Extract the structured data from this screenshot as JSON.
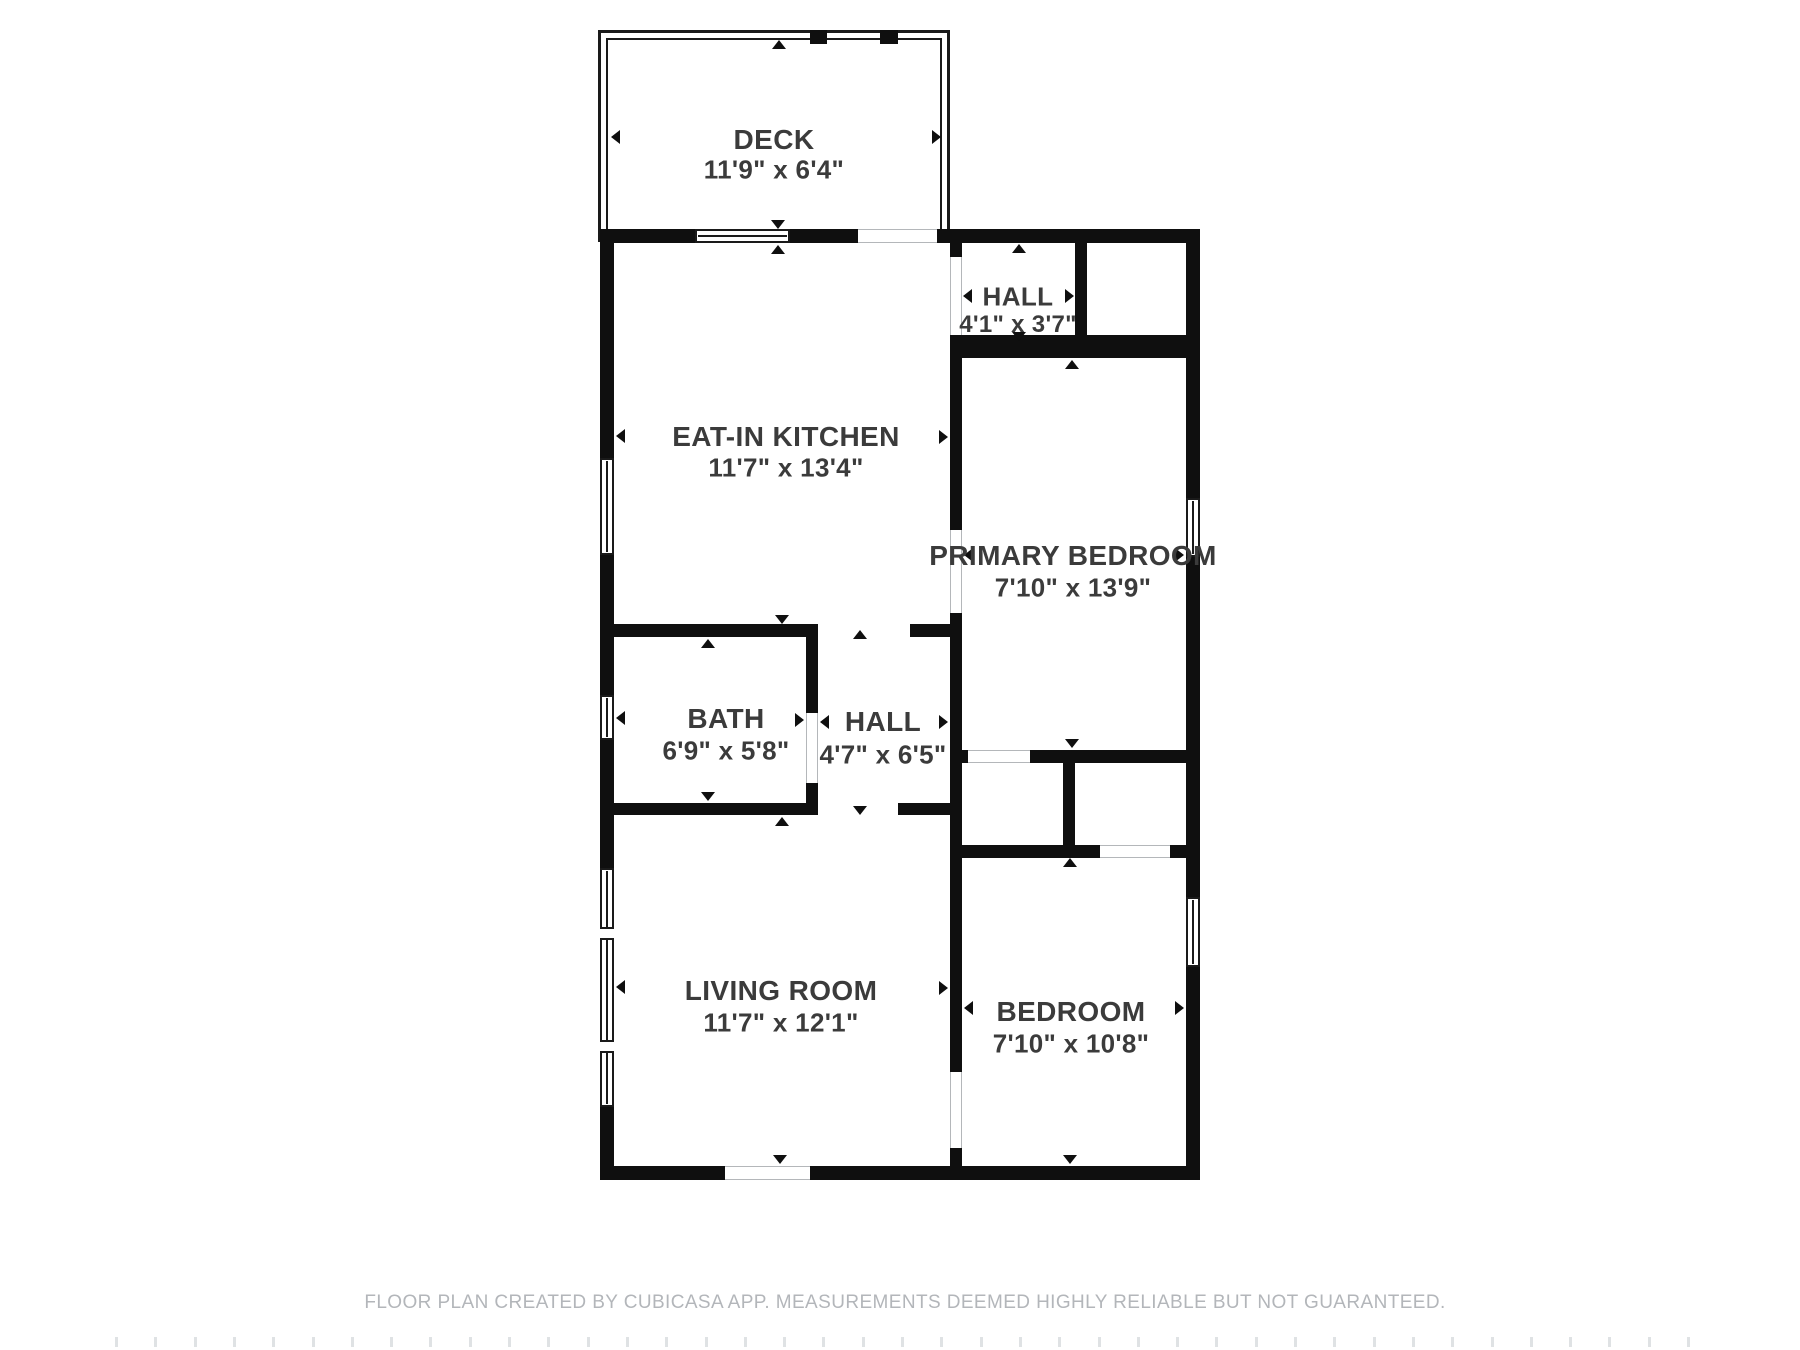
{
  "page": {
    "width": 1800,
    "height": 1350,
    "background": "#ffffff"
  },
  "footer": {
    "text": "FLOOR PLAN CREATED BY CUBICASA APP. MEASUREMENTS DEEMED HIGHLY RELIABLE BUT NOT GUARANTEED.",
    "x": 905,
    "y": 1292,
    "color": "#b3b6ba"
  },
  "plan": {
    "wall_color": "#0f0f0f",
    "label_color": "#3b3b3b",
    "opening_jamb_color": "#b4b7ba",
    "rooms": [
      {
        "id": "deck",
        "name": "DECK",
        "dims": "11'9\" x 6'4\"",
        "cx": 774,
        "ny": 140,
        "dy": 170,
        "name_size": 28,
        "dims_size": 26
      },
      {
        "id": "eat-in-kitchen",
        "name": "EAT-IN KITCHEN",
        "dims": "11'7\" x 13'4\"",
        "cx": 786,
        "ny": 437,
        "dy": 468,
        "name_size": 28,
        "dims_size": 26
      },
      {
        "id": "hall-upper",
        "name": "HALL",
        "dims": "4'1\" x 3'7\"",
        "cx": 1018,
        "ny": 297,
        "dy": 325,
        "name_size": 26,
        "dims_size": 24
      },
      {
        "id": "primary-bedroom",
        "name": "PRIMARY BEDROOM",
        "dims": "7'10\" x 13'9\"",
        "cx": 1073,
        "ny": 556,
        "dy": 588,
        "name_size": 28,
        "dims_size": 26
      },
      {
        "id": "bath",
        "name": "BATH",
        "dims": "6'9\" x 5'8\"",
        "cx": 726,
        "ny": 719,
        "dy": 751,
        "name_size": 28,
        "dims_size": 26
      },
      {
        "id": "hall-center",
        "name": "HALL",
        "dims": "4'7\" x 6'5\"",
        "cx": 883,
        "ny": 722,
        "dy": 755,
        "name_size": 28,
        "dims_size": 26
      },
      {
        "id": "living-room",
        "name": "LIVING ROOM",
        "dims": "11'7\" x 12'1\"",
        "cx": 781,
        "ny": 991,
        "dy": 1023,
        "name_size": 28,
        "dims_size": 26
      },
      {
        "id": "bedroom",
        "name": "BEDROOM",
        "dims": "7'10\" x 10'8\"",
        "cx": 1071,
        "ny": 1012,
        "dy": 1044,
        "name_size": 28,
        "dims_size": 26
      }
    ],
    "deck": {
      "outer": {
        "x": 598,
        "y": 30,
        "w": 352,
        "h": 212
      },
      "inner": {
        "x": 606,
        "y": 38,
        "w": 336,
        "h": 200
      },
      "posts": [
        {
          "x": 810,
          "y": 30,
          "w": 17,
          "h": 14
        },
        {
          "x": 880,
          "y": 30,
          "w": 18,
          "h": 14
        }
      ]
    },
    "walls": [
      {
        "id": "exterior-top-left",
        "x": 600,
        "y": 229,
        "w": 95,
        "h": 14
      },
      {
        "id": "exterior-top-mid",
        "x": 790,
        "y": 229,
        "w": 68,
        "h": 14
      },
      {
        "id": "exterior-top-right",
        "x": 937,
        "y": 229,
        "w": 263,
        "h": 14
      },
      {
        "id": "exterior-left-1",
        "x": 600,
        "y": 243,
        "w": 14,
        "h": 215
      },
      {
        "id": "exterior-left-2",
        "x": 600,
        "y": 555,
        "w": 14,
        "h": 140
      },
      {
        "id": "exterior-left-3",
        "x": 600,
        "y": 740,
        "w": 14,
        "h": 128
      },
      {
        "id": "exterior-left-4",
        "x": 600,
        "y": 1107,
        "w": 14,
        "h": 73
      },
      {
        "id": "exterior-right-1",
        "x": 1186,
        "y": 243,
        "w": 14,
        "h": 255
      },
      {
        "id": "exterior-right-2",
        "x": 1186,
        "y": 557,
        "w": 14,
        "h": 340
      },
      {
        "id": "exterior-right-3",
        "x": 1186,
        "y": 967,
        "w": 14,
        "h": 213
      },
      {
        "id": "exterior-bottom-left",
        "x": 600,
        "y": 1166,
        "w": 125,
        "h": 14
      },
      {
        "id": "exterior-bottom-right",
        "x": 810,
        "y": 1166,
        "w": 390,
        "h": 14
      },
      {
        "id": "hall-upper-left-stub",
        "x": 950,
        "y": 243,
        "w": 12,
        "h": 14
      },
      {
        "id": "hall-upper-right-wall",
        "x": 1075,
        "y": 243,
        "w": 12,
        "h": 104
      },
      {
        "id": "hall-primary-band",
        "x": 950,
        "y": 335,
        "w": 250,
        "h": 23
      },
      {
        "id": "kitchen-primary-wall-1",
        "x": 950,
        "y": 358,
        "w": 12,
        "h": 172
      },
      {
        "id": "kitchen-primary-wall-2",
        "x": 950,
        "y": 613,
        "w": 12,
        "h": 459
      },
      {
        "id": "bedroom-wall-stub",
        "x": 950,
        "y": 1148,
        "w": 12,
        "h": 18
      },
      {
        "id": "bath-top-wall",
        "x": 600,
        "y": 624,
        "w": 218,
        "h": 13
      },
      {
        "id": "kitchen-bottom-stub",
        "x": 910,
        "y": 624,
        "w": 52,
        "h": 13
      },
      {
        "id": "bath-right-wall-upper",
        "x": 806,
        "y": 637,
        "w": 12,
        "h": 76
      },
      {
        "id": "bath-right-wall-lower",
        "x": 806,
        "y": 783,
        "w": 12,
        "h": 20
      },
      {
        "id": "bath-bottom-wall",
        "x": 600,
        "y": 803,
        "w": 218,
        "h": 12
      },
      {
        "id": "living-top-stub",
        "x": 898,
        "y": 803,
        "w": 64,
        "h": 12
      },
      {
        "id": "primary-bottom-stub",
        "x": 950,
        "y": 750,
        "w": 18,
        "h": 13
      },
      {
        "id": "primary-bottom-wall",
        "x": 1030,
        "y": 750,
        "w": 156,
        "h": 13
      },
      {
        "id": "closet-divider-wall",
        "x": 1063,
        "y": 750,
        "w": 12,
        "h": 108
      },
      {
        "id": "bedroom-top-wall-left",
        "x": 950,
        "y": 845,
        "w": 113,
        "h": 13
      },
      {
        "id": "bedroom-top-wall-mid",
        "x": 1075,
        "y": 845,
        "w": 25,
        "h": 13
      },
      {
        "id": "bedroom-top-wall-stub",
        "x": 1170,
        "y": 845,
        "w": 16,
        "h": 13
      }
    ],
    "windows": [
      {
        "id": "deck-wall-window",
        "x": 695,
        "y": 229,
        "w": 95,
        "h": 14,
        "orient": "h"
      },
      {
        "id": "kitchen-window",
        "x": 600,
        "y": 458,
        "w": 14,
        "h": 97,
        "orient": "v"
      },
      {
        "id": "bath-window",
        "x": 600,
        "y": 695,
        "w": 14,
        "h": 45,
        "orient": "v"
      },
      {
        "id": "living-room-window",
        "x": 600,
        "y": 868,
        "w": 14,
        "h": 239,
        "orient": "v"
      },
      {
        "id": "primary-window",
        "x": 1186,
        "y": 498,
        "w": 14,
        "h": 59,
        "orient": "v"
      },
      {
        "id": "bedroom-window",
        "x": 1186,
        "y": 897,
        "w": 14,
        "h": 70,
        "orient": "v"
      }
    ],
    "window_dividers": [
      {
        "id": "living-window-divider-1",
        "x": 600,
        "y": 927,
        "w": 14,
        "h": 13
      },
      {
        "id": "living-window-divider-2",
        "x": 600,
        "y": 1040,
        "w": 14,
        "h": 13
      }
    ],
    "openings": [
      {
        "id": "deck-door-opening",
        "x": 858,
        "y": 229,
        "w": 79,
        "h": 14,
        "orient": "h"
      },
      {
        "id": "entry-opening",
        "x": 725,
        "y": 1166,
        "w": 85,
        "h": 14,
        "orient": "h"
      },
      {
        "id": "hall-upper-opening",
        "x": 950,
        "y": 257,
        "w": 12,
        "h": 78,
        "orient": "v"
      },
      {
        "id": "primary-door-opening",
        "x": 950,
        "y": 530,
        "w": 12,
        "h": 83,
        "orient": "v"
      },
      {
        "id": "bath-door-opening",
        "x": 806,
        "y": 713,
        "w": 12,
        "h": 70,
        "orient": "v"
      },
      {
        "id": "closet-opening",
        "x": 968,
        "y": 750,
        "w": 62,
        "h": 13,
        "orient": "h"
      },
      {
        "id": "bedroom-closet-opening",
        "x": 1100,
        "y": 845,
        "w": 70,
        "h": 13,
        "orient": "h"
      },
      {
        "id": "bedroom-door-opening",
        "x": 950,
        "y": 1072,
        "w": 12,
        "h": 76,
        "orient": "v"
      }
    ],
    "arrows": [
      {
        "room": "deck",
        "dir": "up",
        "x": 779,
        "y": 40
      },
      {
        "room": "deck",
        "dir": "down",
        "x": 778,
        "y": 229
      },
      {
        "room": "deck",
        "dir": "left",
        "x": 611,
        "y": 137
      },
      {
        "room": "deck",
        "dir": "right",
        "x": 941,
        "y": 137
      },
      {
        "room": "kitchen",
        "dir": "up",
        "x": 778,
        "y": 245
      },
      {
        "room": "kitchen",
        "dir": "down",
        "x": 782,
        "y": 624
      },
      {
        "room": "kitchen",
        "dir": "left",
        "x": 616,
        "y": 436
      },
      {
        "room": "kitchen",
        "dir": "right",
        "x": 948,
        "y": 437
      },
      {
        "room": "hall-upper",
        "dir": "up",
        "x": 1019,
        "y": 244
      },
      {
        "room": "hall-upper",
        "dir": "down",
        "x": 1019,
        "y": 341
      },
      {
        "room": "hall-upper",
        "dir": "left",
        "x": 963,
        "y": 296
      },
      {
        "room": "hall-upper",
        "dir": "right",
        "x": 1074,
        "y": 296
      },
      {
        "room": "bath",
        "dir": "up",
        "x": 708,
        "y": 639
      },
      {
        "room": "bath",
        "dir": "down",
        "x": 708,
        "y": 801
      },
      {
        "room": "bath",
        "dir": "left",
        "x": 616,
        "y": 718
      },
      {
        "room": "bath",
        "dir": "right",
        "x": 804,
        "y": 720
      },
      {
        "room": "hall-center",
        "dir": "up",
        "x": 860,
        "y": 630
      },
      {
        "room": "hall-center",
        "dir": "down",
        "x": 860,
        "y": 815
      },
      {
        "room": "hall-center",
        "dir": "left",
        "x": 820,
        "y": 722
      },
      {
        "room": "hall-center",
        "dir": "right",
        "x": 948,
        "y": 722
      },
      {
        "room": "primary",
        "dir": "up",
        "x": 1072,
        "y": 360
      },
      {
        "room": "primary",
        "dir": "down",
        "x": 1072,
        "y": 748
      },
      {
        "room": "primary",
        "dir": "left",
        "x": 964,
        "y": 555
      },
      {
        "room": "primary",
        "dir": "right",
        "x": 1184,
        "y": 555
      },
      {
        "room": "bedroom",
        "dir": "up",
        "x": 1070,
        "y": 858
      },
      {
        "room": "bedroom",
        "dir": "down",
        "x": 1070,
        "y": 1164
      },
      {
        "room": "bedroom",
        "dir": "left",
        "x": 964,
        "y": 1008
      },
      {
        "room": "bedroom",
        "dir": "right",
        "x": 1184,
        "y": 1008
      },
      {
        "room": "living",
        "dir": "up",
        "x": 782,
        "y": 817
      },
      {
        "room": "living",
        "dir": "down",
        "x": 780,
        "y": 1164
      },
      {
        "room": "living",
        "dir": "left",
        "x": 616,
        "y": 987
      },
      {
        "room": "living",
        "dir": "right",
        "x": 948,
        "y": 988
      }
    ],
    "ruler": {
      "y": 1337,
      "tick_w": 3,
      "tick_h": 10,
      "start_x": 115,
      "step": 39.3,
      "count": 41,
      "color": "#dfe2e4"
    }
  }
}
